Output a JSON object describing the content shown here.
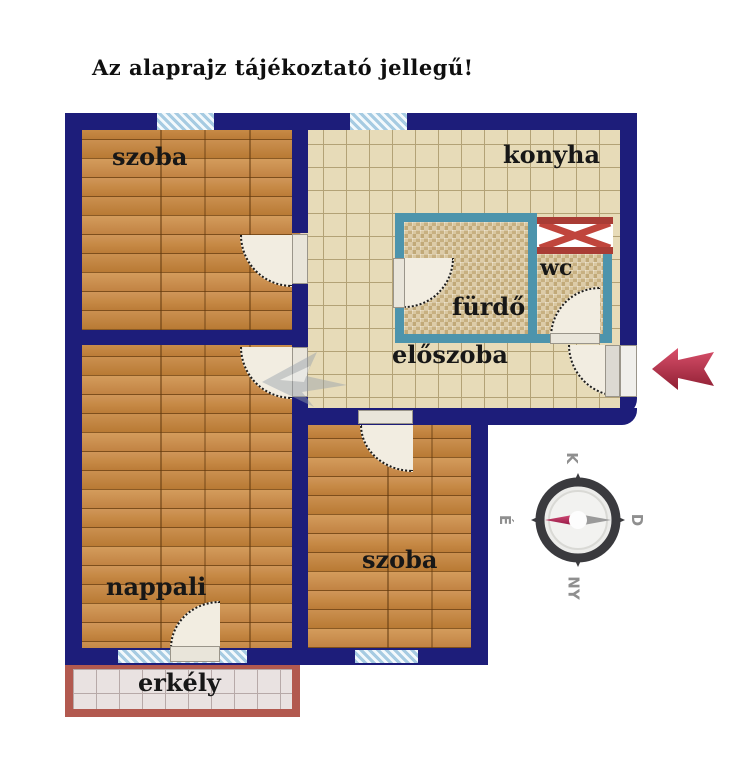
{
  "title": "Az alaprajz tájékoztató jellegű!",
  "rooms": {
    "room_top": "szoba",
    "kitchen": "konyha",
    "bathroom": "fürdő",
    "wc": "wc",
    "hall": "előszoba",
    "living": "nappali",
    "room_bottom": "szoba",
    "balcony": "erkély"
  },
  "compass": {
    "east": "K",
    "south": "D",
    "west": "NY",
    "north": "É"
  },
  "icons": {
    "entrance_arrow": "left-arrow-icon",
    "vent": "vent-x-icon",
    "compass": "compass-rose-icon"
  },
  "colors": {
    "wall": "#1d1d7a",
    "bath_wall_teal": "#4d94ac",
    "vent_red": "#a93c35",
    "balcony_wall": "#b2594f",
    "arrow_red": "#b52b43",
    "wood_floor": "#c08040",
    "kitchen_tile": "#e7dbb8",
    "mosaic_tile": "#d5c29a",
    "window_blue": "#a6cbe2",
    "door_fill": "#f2ede1",
    "needle_red": "#b62054"
  }
}
